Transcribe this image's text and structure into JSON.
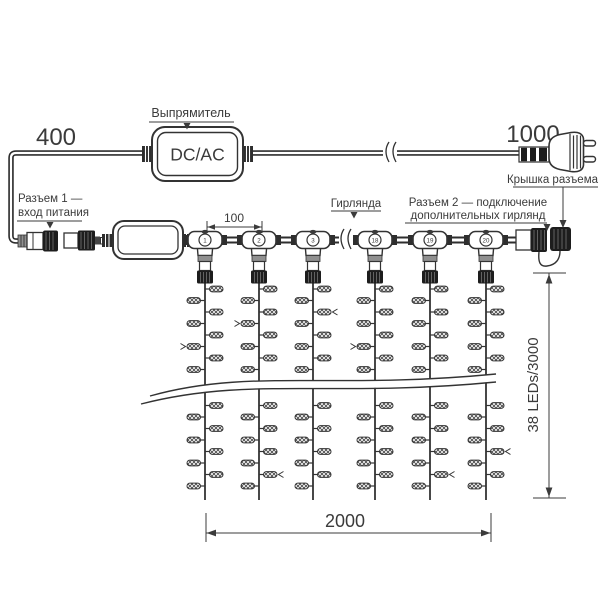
{
  "diagram": {
    "labels": {
      "rectifier": "Выпрямитель",
      "converter": "DC/AC",
      "connector1_line1": "Разъем 1 —",
      "connector1_line2": "вход питания",
      "garland": "Гирлянда",
      "connector2_line1": "Разъем 2 — подключение",
      "connector2_line2": "дополнительных гирлянд",
      "connector_cap": "Крышка разъема"
    },
    "dimensions": {
      "input_lead_mm": "400",
      "power_lead_mm": "1000",
      "string_spacing_mm": "100",
      "curtain_width_mm": "2000",
      "string_drop": "38 LEDs/3000"
    },
    "junctions": [
      "1",
      "2",
      "3",
      "18",
      "19",
      "20"
    ],
    "colors": {
      "line": "#333333",
      "text": "#3b3b3b",
      "connector_dark": "#1d1d1d",
      "connector_gray": "#909090"
    }
  }
}
